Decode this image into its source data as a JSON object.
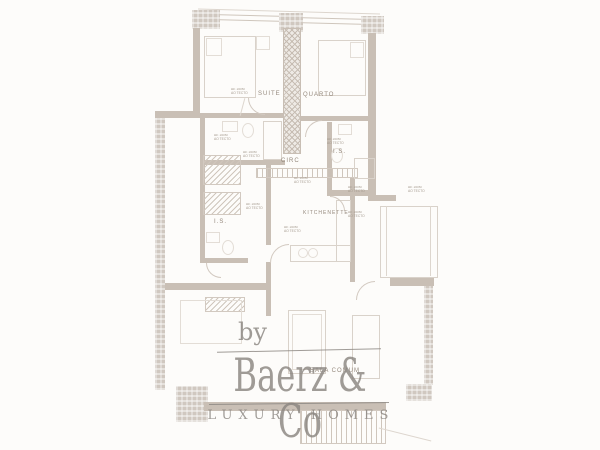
{
  "colors": {
    "background": "#fdfcfa",
    "wall": "#c9bfb5",
    "thin_line": "#cfc6bc",
    "furniture_line": "#d9d2ca",
    "room_label": "#95897d",
    "watermark": "#8b8681"
  },
  "floorplan": {
    "rooms": [
      {
        "id": "suite",
        "label": "SUITE"
      },
      {
        "id": "quarto",
        "label": "QUARTO"
      },
      {
        "id": "is_right",
        "label": "I.S."
      },
      {
        "id": "circ",
        "label": "CIRC"
      },
      {
        "id": "kitchenette",
        "label": "KITCHENETTE"
      },
      {
        "id": "is_left",
        "label": "I.S."
      },
      {
        "id": "sala_comum",
        "label": "SALA COMUM"
      }
    ],
    "vent_note": {
      "line1": "AE 150M",
      "line2": "AO TECTO"
    }
  },
  "watermark": {
    "prefix": "by",
    "brand": "Baerz & Co",
    "tagline": "LUXURY HOMES"
  }
}
